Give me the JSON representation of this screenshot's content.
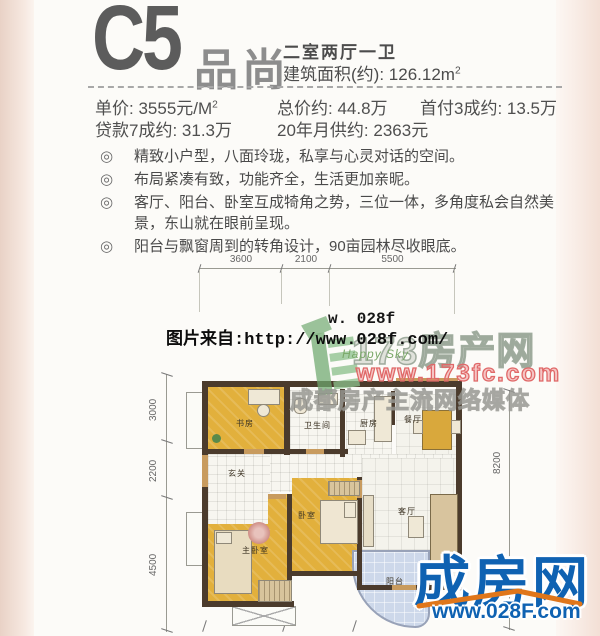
{
  "header": {
    "code": "C5",
    "name": "品尚",
    "layout": "二室两厅一卫",
    "area_label": "建筑面积(约):",
    "area_value": "126.12m",
    "area_sup": "2"
  },
  "pricing": {
    "unit_label": "单价:",
    "unit_value": "3555元/M",
    "unit_sup": "2",
    "total_label": "总价约:",
    "total_value": "44.8万",
    "downpay_label": "首付3成约:",
    "downpay_value": "13.5万",
    "loan_label": "贷款7成约:",
    "loan_value": "31.3万",
    "monthly_label": "20年月供约:",
    "monthly_value": "2363元"
  },
  "features": {
    "bullet": "◎",
    "items": [
      "精致小户型，八面玲珑，私享与心灵对话的空间。",
      "布局紧凑有致，功能齐全，生活更加亲昵。",
      "客厅、阳台、卧室互成犄角之势，三位一体，多角度私会自然美景，东山就在眼前呈现。",
      "阳台与飘窗周到的转角设计，90亩园林尽收眼底。"
    ]
  },
  "floorplan": {
    "dims_top": [
      "3600",
      "2100",
      "5500"
    ],
    "dims_left": [
      "3000",
      "2200",
      "4500"
    ],
    "dim_right": "8200",
    "rooms": {
      "study": "书房",
      "bath": "卫生间",
      "kitchen": "厨房",
      "dining": "餐厅",
      "foyer": "玄关",
      "master": "主卧室",
      "bedroom": "卧室",
      "living": "客厅",
      "balcony": "阳台"
    }
  },
  "watermarks": {
    "source_url": "图片来自:http://www.028f.com/",
    "partial_url": "w. 028f",
    "happy_sky": "Happy Sky",
    "brand_173": "173房产网",
    "brand_173_url": "www.173fc.com",
    "media_line": "成都房产主流网络媒体",
    "logo_name": "成房网",
    "logo_url": "www.028F.com"
  },
  "colors": {
    "logo_blue": "#0f62b2",
    "swoosh_orange": "#e0761a",
    "brand_red": "#e06868",
    "room_yellow": "#e2b03c",
    "wall_brown": "#4b3b2c",
    "balcony_blue": "#cdd8ea"
  }
}
